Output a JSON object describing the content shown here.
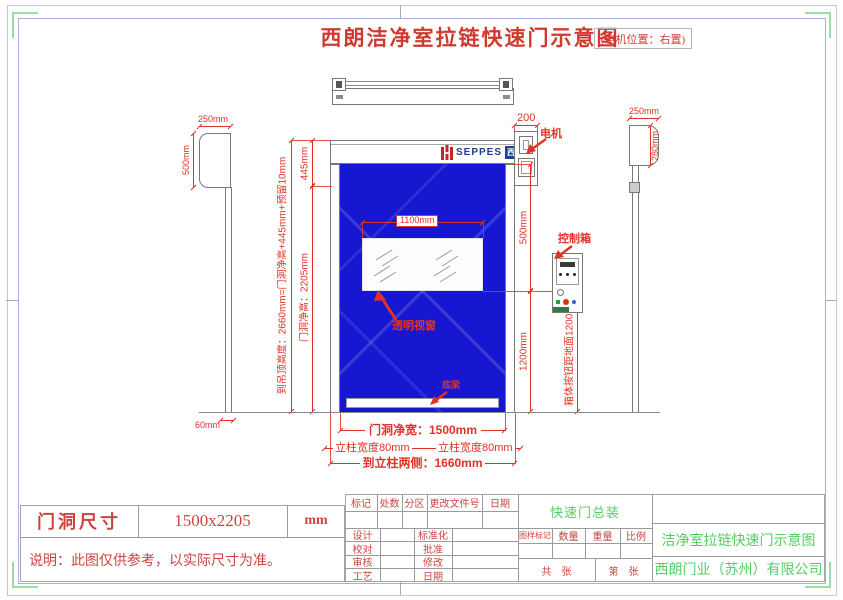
{
  "sheet": {
    "title": "西朗洁净室拉链快速门示意图",
    "motor_position_note": "(电机位置：右置)"
  },
  "logo": {
    "brand": "SEPPES",
    "brand_cn": "西朗"
  },
  "annotations": {
    "motor": "电机",
    "control_box": "控制箱",
    "window": "透明视窗",
    "bottom_beam": "底梁"
  },
  "dims": {
    "motor_width": "200",
    "left_hood_w": "250mm",
    "left_hood_h": "500mm",
    "left_rail_w": "60mm",
    "right_hood_w": "250mm",
    "right_hood_h": "280mm",
    "ceiling": "到吊顶高度：2660mm=门洞净高+445mm+预留10mm",
    "header_h": "445mm",
    "clear_h": "门洞净高：2205mm",
    "window_w": "1100mm",
    "window_top": "500mm",
    "button_h": "1200mm",
    "button_note": "箱体按钮距地面1200mm",
    "clear_w": "门洞净宽：1500mm",
    "col_w_l": "立柱宽度80mm",
    "col_w_r": "立柱宽度80mm",
    "total_w": "到立柱两侧：1660mm"
  },
  "spec": {
    "label": "门洞尺寸",
    "value": "1500x2205",
    "unit": "mm",
    "note": "说明：此图仅供参考，以实际尺寸为准。"
  },
  "tb": {
    "rev": [
      "标记",
      "处数",
      "分区",
      "更改文件号",
      "日期"
    ],
    "sign_l": [
      "设计",
      "校对",
      "审核",
      "工艺"
    ],
    "sign_r": [
      "标准化",
      "批准",
      "修改",
      "日期"
    ],
    "assembly": "快速门总装",
    "info": [
      "图样标记",
      "数量",
      "重量",
      "比例"
    ],
    "sheets_total": "共　张",
    "sheets_page": "第　张",
    "drawing_title": "洁净室拉链快速门示意图",
    "company": "西朗门业（苏州）有限公司"
  }
}
